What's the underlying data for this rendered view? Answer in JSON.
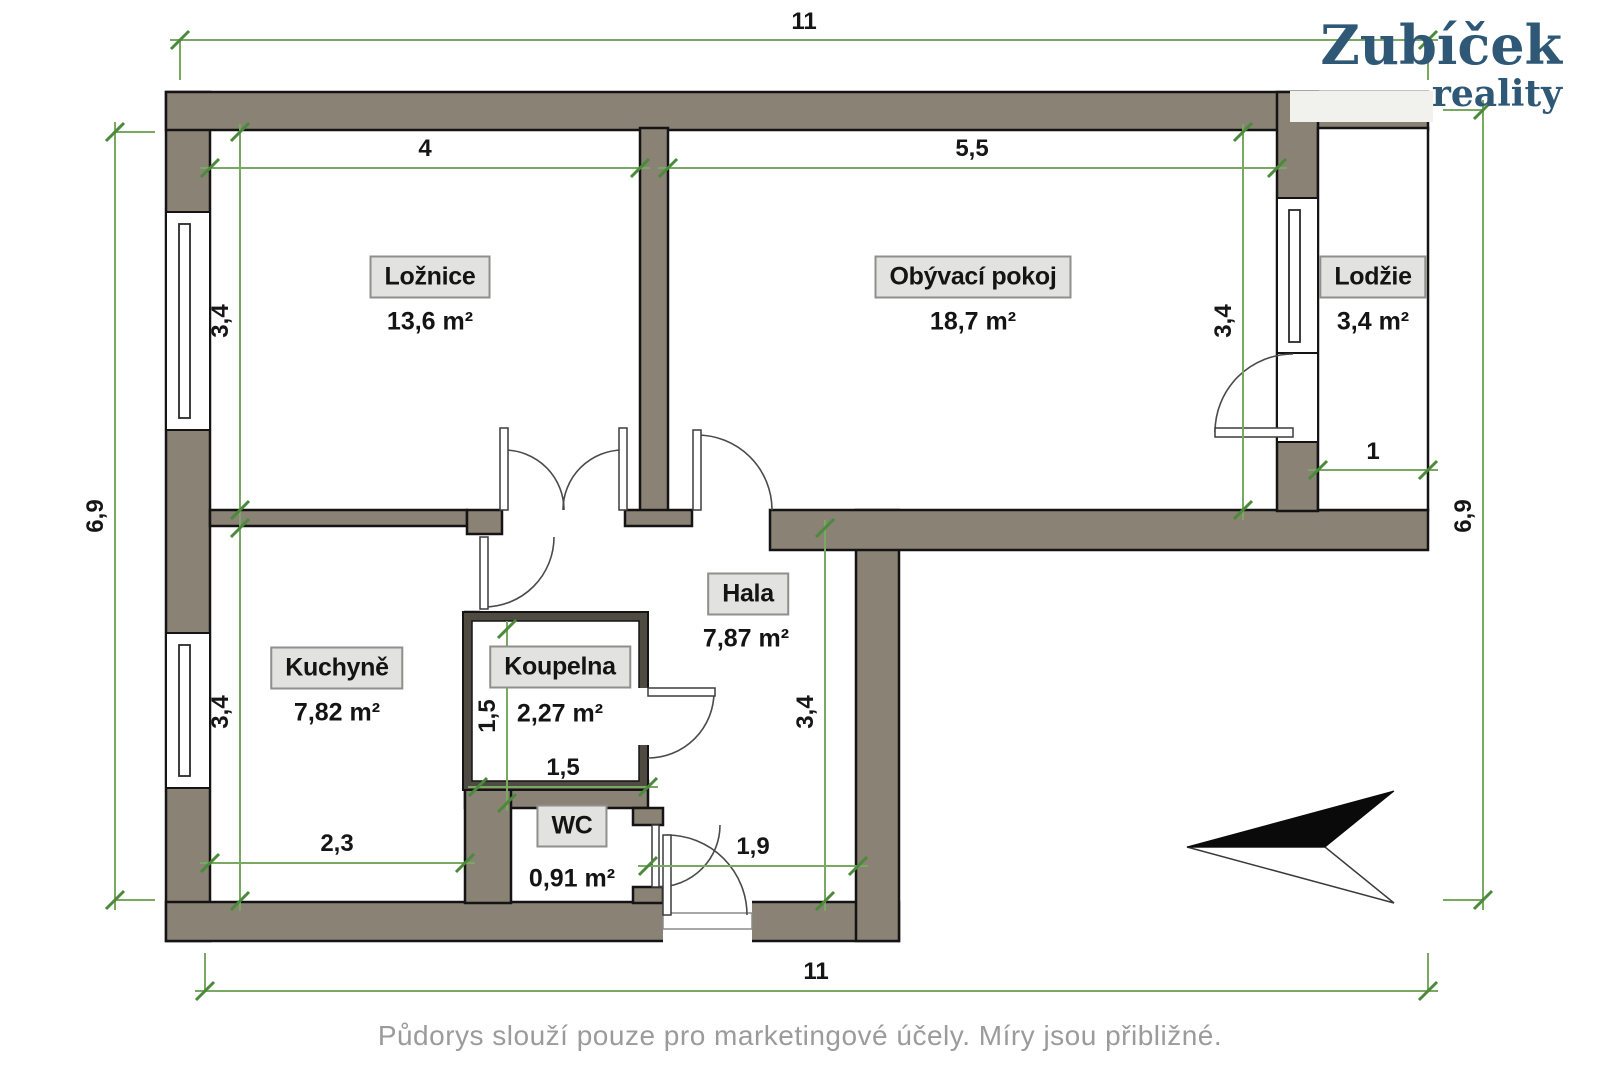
{
  "brand": {
    "name": "Zubíček",
    "tagline": "reality"
  },
  "footer": {
    "disclaimer": "Půdorys slouží pouze pro marketingové účely. Míry jsou přibližné."
  },
  "rooms": [
    {
      "name": "Ložnice",
      "area": "13,6 m²"
    },
    {
      "name": "Obývací pokoj",
      "area": "18,7 m²"
    },
    {
      "name": "Lodžie",
      "area": "3,4 m²"
    },
    {
      "name": "Kuchyně",
      "area": "7,82 m²"
    },
    {
      "name": "Koupelna",
      "area": "2,27 m²"
    },
    {
      "name": "Hala",
      "area": "7,87 m²"
    },
    {
      "name": "WC",
      "area": "0,91 m²"
    }
  ],
  "dimensions": {
    "overall_top": "11",
    "overall_bottom": "11",
    "overall_left": "6,9",
    "overall_right": "6,9",
    "bedroom_width": "4",
    "bedroom_height": "3,4",
    "living_width": "5,5",
    "living_height": "3,4",
    "loggia_width": "1",
    "kitchen_height": "3,4",
    "kitchen_width": "2,3",
    "bathroom_height": "1,5",
    "bathroom_width": "1,5",
    "hall_height": "3,4",
    "entry_width": "1,9"
  },
  "colors": {
    "wall": "#8a8275",
    "dimension_line": "#79a862",
    "dimension_tick": "#4a8a3a",
    "label_box_bg": "#e2e2e0",
    "brand_text": "#2e5876",
    "footer_text": "#9b9b9b"
  },
  "icons": {
    "north_arrow": "north-arrow"
  }
}
